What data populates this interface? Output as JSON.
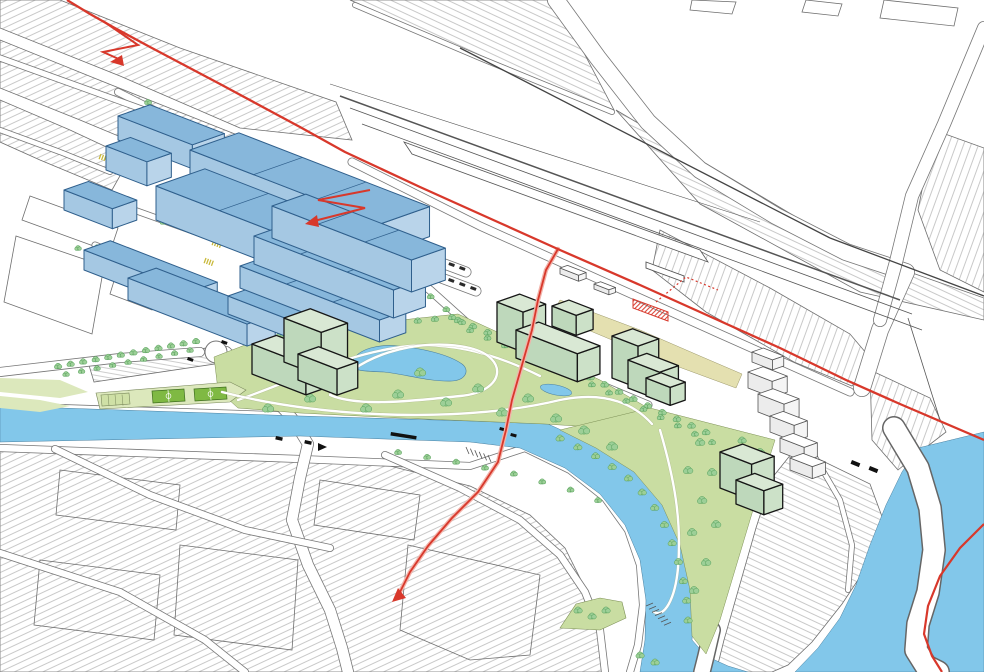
{
  "canvas": {
    "width": 984,
    "height": 672
  },
  "palette": {
    "paper": "#FFFFFF",
    "line": "#4A4A4A",
    "fabricLine": "#6E6E6E",
    "water": "#82C7EA",
    "park": "#C9DDA2",
    "parkLight": "#DCE8BC",
    "pitch": "#7FB943",
    "pitchLine": "#3E6E1E",
    "beige": "#E4E0B0",
    "tree": "#9CCF97",
    "treeStroke": "#55A05A",
    "blueTop": "#87B7DB",
    "blueFront": "#A5C8E3",
    "blueSide": "#B9D4EA",
    "blueLine": "#2F5F8C",
    "greenTop": "#D9E8D4",
    "greenFront": "#BED8BB",
    "greenSide": "#CCE1C8",
    "greenLine": "#161616",
    "whiteTop": "#FFFFFF",
    "whiteFront": "#ECECEC",
    "whiteSide": "#F5F5F5",
    "route": "#D8382B",
    "routeHalo": "#F2B3AA",
    "crossing": "#C9B93B",
    "car": "#2B2B2B"
  }
}
